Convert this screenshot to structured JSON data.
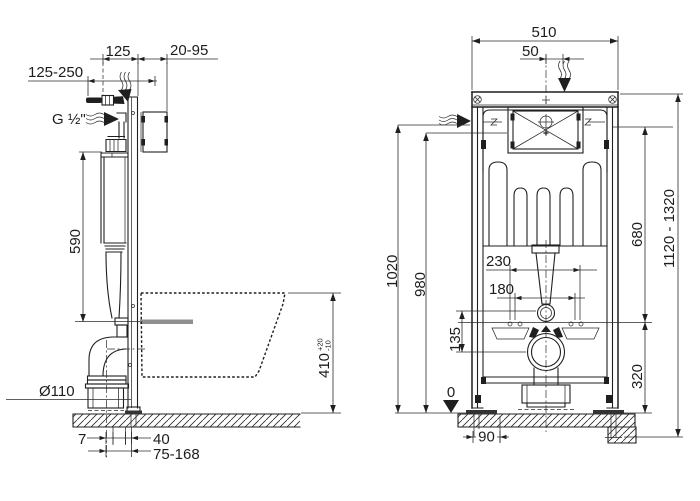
{
  "colors": {
    "line": "#1f1f1f",
    "dimension_line": "#2b2b2b",
    "seat_axis_gray": "#8f8f8f",
    "foot_plate": "#333333",
    "background": "#ffffff"
  },
  "left_view": {
    "name": "side-view",
    "labels": {
      "top_width": "125",
      "wall_distance": "20-95",
      "supply_range": "125-250",
      "supply_thread": "G ½\"",
      "cistern_height": "590",
      "bowl_height": "410",
      "bowl_tol_plus": "+20",
      "bowl_tol_minus": "-10",
      "drain_diameter": "Ø110",
      "dim_7": "7",
      "dim_40": "40",
      "dim_75_168": "75-168"
    }
  },
  "right_view": {
    "name": "front-view",
    "labels": {
      "frame_width": "510",
      "supply_offset": "50",
      "height_1020": "1020",
      "height_980": "980",
      "spacing_230": "230",
      "spacing_180": "180",
      "offset_135": "135",
      "datum": "0",
      "foot_offset_90": "90",
      "height_680": "680",
      "height_range": "1120 - 1320",
      "height_320": "320"
    }
  }
}
